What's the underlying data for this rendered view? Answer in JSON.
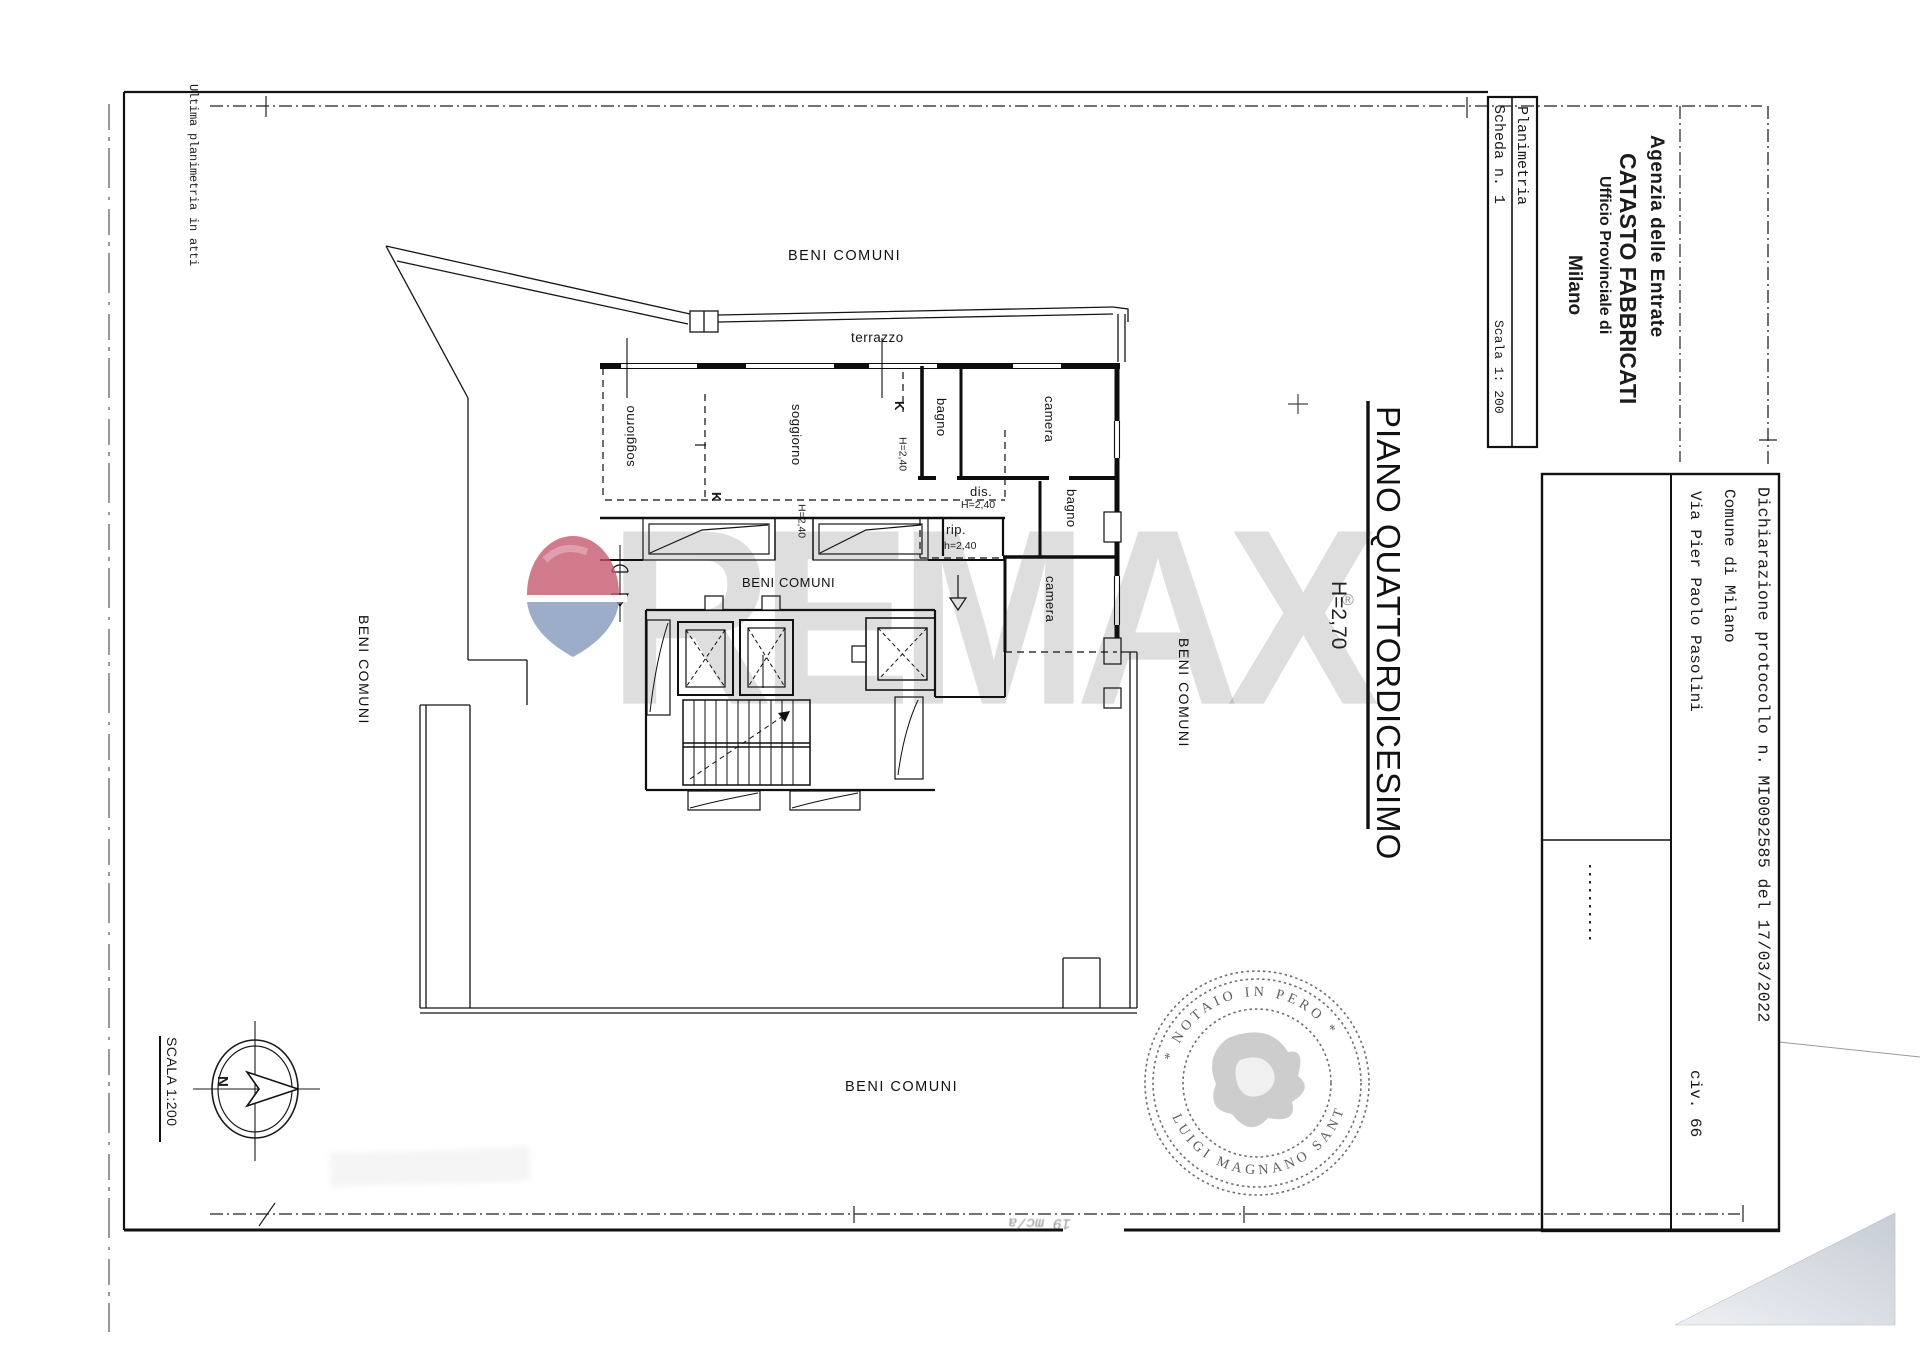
{
  "margin_note": "Ultima planimetria in atti",
  "sheet_box": {
    "doc_type": "Planimetria",
    "sheet_no": "Scheda n. 1",
    "scale": "Scala 1: 200"
  },
  "agency": {
    "line1": "Agenzia delle Entrate",
    "line2": "CATASTO FABBRICATI",
    "line3": "Ufficio Provinciale di",
    "line4": "Milano"
  },
  "right_panel": {
    "declaration": "Dichiarazione protocollo n. MI0092585 del 17/03/2022",
    "municipality": "Comune di Milano",
    "street": "Via Pier Paolo Pasolini",
    "civic": "civ. 66"
  },
  "title_block": {
    "floor_title": "PIANO QUATTORDICESIMO",
    "height_note": "H=2,70"
  },
  "plan": {
    "beni_comuni": "BENI COMUNI",
    "terrazzo": "terrazzo",
    "soggiorno": "soggiorno",
    "bagno": "bagno",
    "camera": "camera",
    "dis": "dis.",
    "rip": "rip.",
    "h_240_upper": "H=2,40",
    "h_240_lower": "h=2,40",
    "section_mark": "K"
  },
  "compass": {
    "scale_label": "SCALA 1:200",
    "north": "N"
  },
  "stamp": {
    "arc_top": "* NOTAIO IN PERO *",
    "arc_bottom": "LUIGI MAGNANO SANT"
  },
  "watermark": {
    "letters": "REMAX",
    "registered": "®",
    "balloon_red": "#c4556a",
    "balloon_blue": "#8096ba"
  },
  "artifacts": {
    "handwritten_note": "19 mc/a",
    "corner_shade": "#cdd3da"
  }
}
